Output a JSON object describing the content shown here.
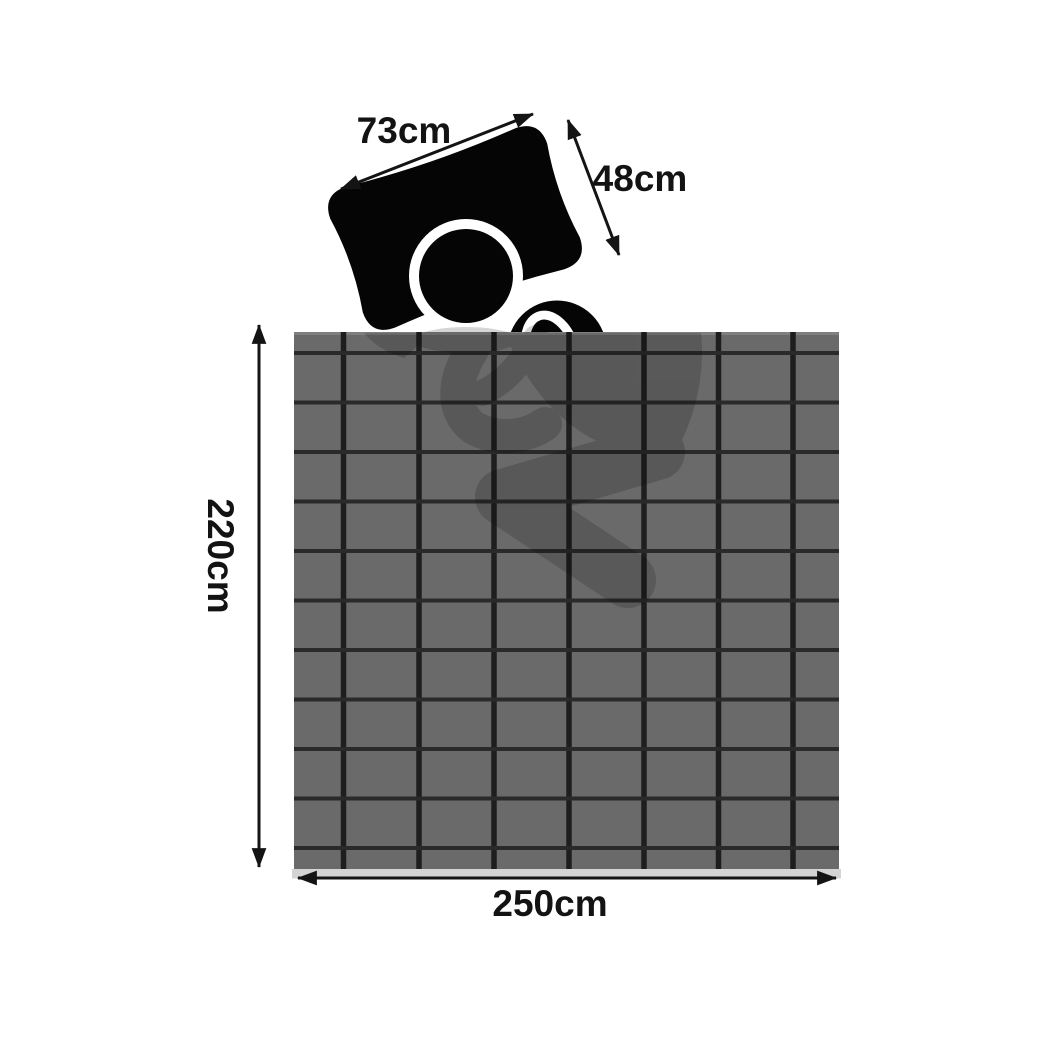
{
  "diagram": {
    "title": "bed-linen-dimension-diagram",
    "labels": {
      "pillow_width": "73cm",
      "pillow_height": "48cm",
      "blanket_height": "220cm",
      "blanket_width": "250cm"
    },
    "colors": {
      "background": "#ffffff",
      "ink": "#141414",
      "pillow": "#050505",
      "head": "#050505",
      "shoulder": "#050505",
      "blanket": "#6a6a6a",
      "grid_line_vertical": "#1e1e1e",
      "grid_line_horizontal": "#2a2a2a",
      "bottom_shadow": "#d4d4d4"
    },
    "blanket": {
      "grid_columns": 8,
      "grid_rows": 12
    },
    "icons": [
      "pillow-icon",
      "sleeping-person-icon",
      "weighted-blanket-grid-icon",
      "double-arrow-icon"
    ]
  }
}
